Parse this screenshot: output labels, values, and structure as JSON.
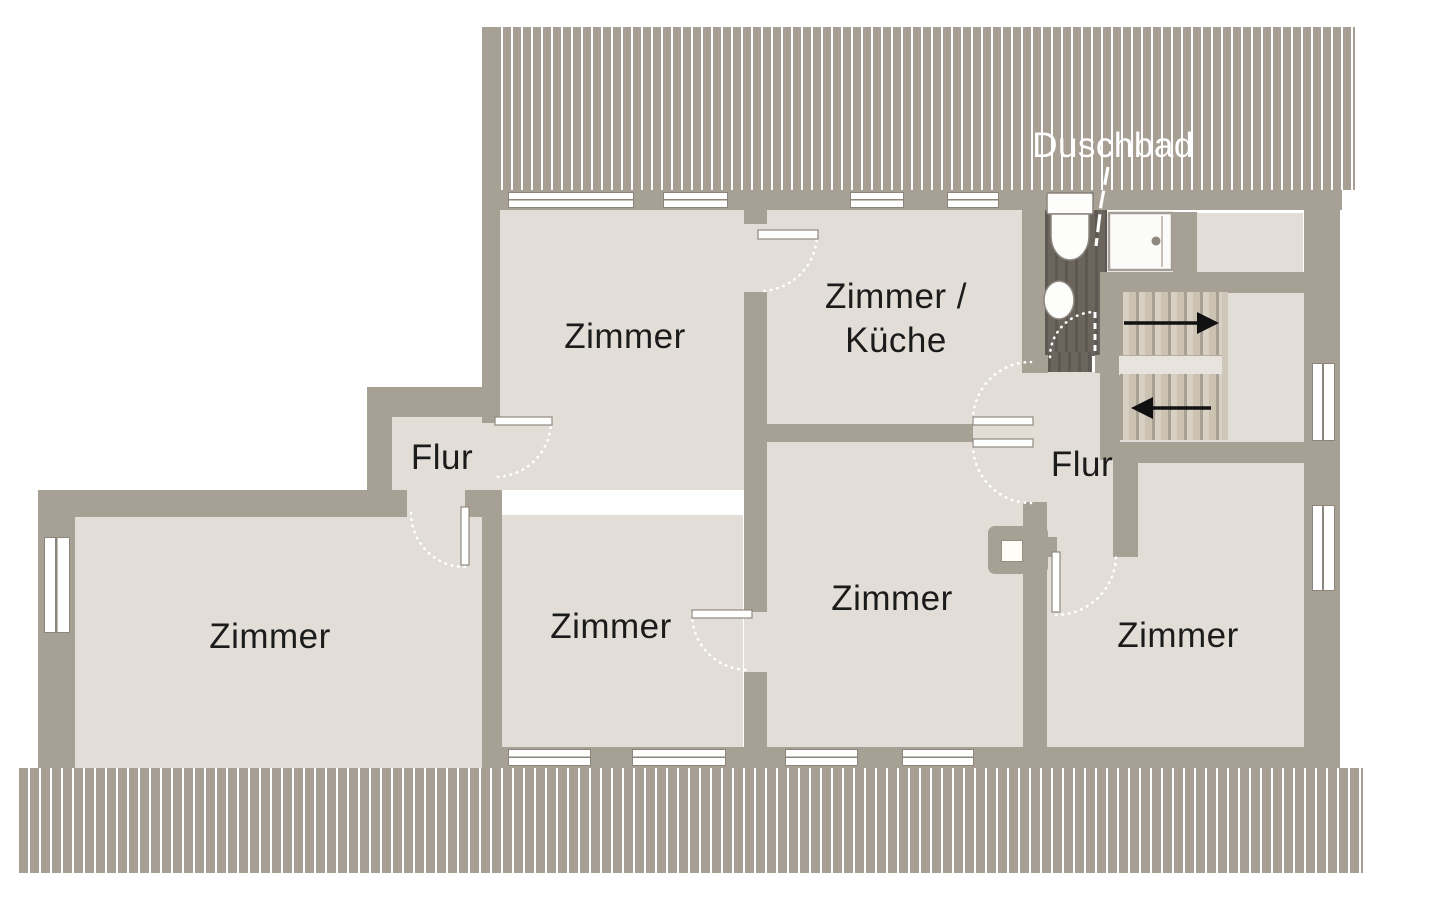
{
  "title": "Grundriss Dachgeschoss (floor plan)",
  "labels": {
    "bathroom": "Duschbad",
    "room_top_left": "Zimmer",
    "room_kitchen_line1": "Zimmer /",
    "room_kitchen_line2": "Küche",
    "hall_small": "Flur",
    "room_left": "Zimmer",
    "room_center_left": "Zimmer",
    "room_center": "Zimmer",
    "hall_right": "Flur",
    "room_right": "Zimmer"
  },
  "fixtures": {
    "toilet": "toilet-icon",
    "sink": "sink-icon",
    "shower": "shower-icon",
    "chimney": "chimney-icon",
    "stairs": "staircase",
    "stairs_up_arrow": "arrow-right-icon",
    "stairs_down_arrow": "arrow-left-icon",
    "door_swings": "door-arc-icon",
    "roof_hatch": "roof-hatch-pattern"
  },
  "colors": {
    "background": "#ffffff",
    "wall": "#a7a094",
    "floor": "#e2ded7",
    "roof_hatch": "#a79f93",
    "bathroom_floor": "#6b655e",
    "stair_tread": "#d8d0c2",
    "label_text": "#1b1b1b",
    "bathroom_label_text": "#ffffff",
    "arrow": "#111111"
  }
}
